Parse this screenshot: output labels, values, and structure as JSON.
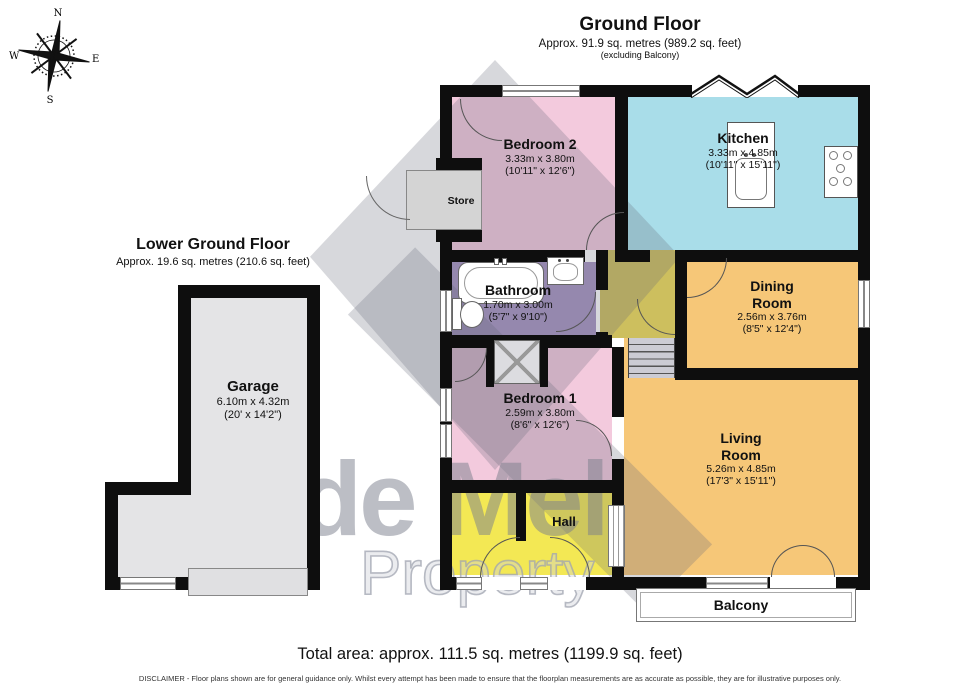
{
  "compass": {
    "n": "N",
    "e": "E",
    "s": "S",
    "w": "W"
  },
  "titles": {
    "ground_floor": {
      "title": "Ground Floor",
      "area": "Approx. 91.9 sq. metres (989.2 sq. feet)",
      "note": "(excluding Balcony)"
    },
    "lower_ground_floor": {
      "title": "Lower Ground Floor",
      "area": "Approx. 19.6 sq. metres (210.6 sq. feet)"
    }
  },
  "rooms": {
    "bedroom2": {
      "name": "Bedroom 2",
      "metric": "3.33m x 3.80m",
      "imperial": "(10'11\" x 12'6\")"
    },
    "kitchen": {
      "name": "Kitchen",
      "metric": "3.33m x 4.85m",
      "imperial": "(10'11\" x 15'11\")"
    },
    "bathroom": {
      "name": "Bathroom",
      "metric": "1.70m x 3.00m",
      "imperial": "(5'7\" x 9'10\")"
    },
    "dining_room": {
      "name": "Dining Room",
      "metric": "2.56m x 3.76m",
      "imperial": "(8'5\" x 12'4\")"
    },
    "bedroom1": {
      "name": "Bedroom 1",
      "metric": "2.59m x 3.80m",
      "imperial": "(8'6\" x 12'6\")"
    },
    "living_room": {
      "name": "Living Room",
      "metric": "5.26m x 4.85m",
      "imperial": "(17'3\" x 15'11\")"
    },
    "garage": {
      "name": "Garage",
      "metric": "6.10m x 4.32m",
      "imperial": "(20' x 14'2\")"
    },
    "hall": {
      "name": "Hall"
    },
    "store": {
      "name": "Store"
    },
    "balcony": {
      "name": "Balcony"
    }
  },
  "watermark": {
    "brand": "de Mel",
    "sub": "Property"
  },
  "footer": {
    "total_area": "Total area: approx. 111.5 sq. metres (1199.9 sq. feet)",
    "disclaimer": "DISCLAIMER -  Floor plans shown are for general guidance only. Whilst every attempt has been made to ensure that the floorplan measurements are as accurate as possible, they are for illustrative purposes only."
  },
  "colors": {
    "bedroom": "#f3cadd",
    "kitchen": "#a9dde9",
    "bathroom": "#a794c1",
    "dining_living": "#f6c778",
    "hall": "#f3e854",
    "inner_hall": "#cdbf5e",
    "garage": "#e4e4e6",
    "store": "#d4d4d4",
    "wall": "#0e0e0e"
  }
}
